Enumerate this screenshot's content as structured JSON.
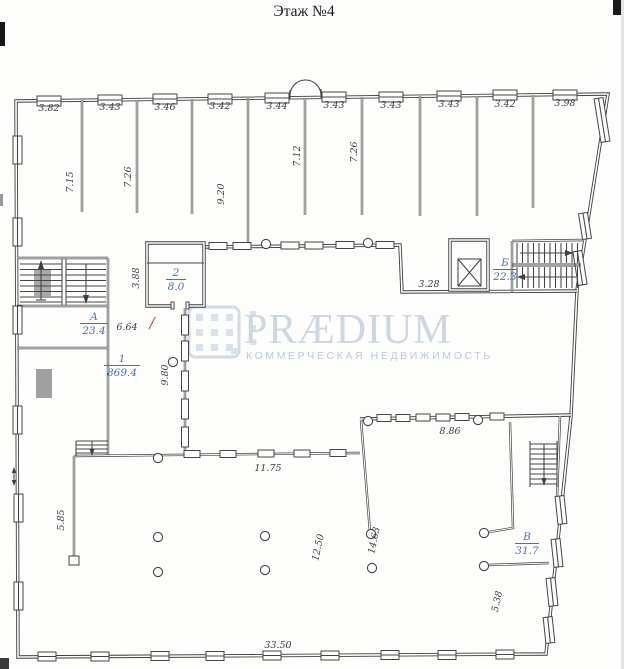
{
  "title": "Этаж №4",
  "watermark": {
    "brand": "PRÆDIUM",
    "tagline": "КОММЕРЧЕСКАЯ НЕДВИЖИМОСТЬ"
  },
  "rooms": {
    "r1": {
      "num": "1",
      "area": "869.4"
    },
    "r2": {
      "num": "2",
      "area": "8.0"
    },
    "rA": {
      "num": "А",
      "area": "23.4"
    },
    "rB": {
      "num": "Б",
      "area": "22.3"
    },
    "rV": {
      "num": "В",
      "area": "31.7"
    }
  },
  "red_mark": "/",
  "dims": {
    "top": [
      "3.82",
      "3.43",
      "3.46",
      "3.42",
      "3.44",
      "3.43",
      "3.43",
      "3.43",
      "3.42",
      "3.98"
    ],
    "depths": [
      "7.15",
      "7.26",
      "9.20",
      "7.12",
      "7.26"
    ],
    "closet_width": "3.88",
    "lift_span": "3.28",
    "inner_gap": "6.64",
    "west_hall_depth": "9.80",
    "south_wall": "11.75",
    "southeast_top": "8.86",
    "left_lower": "5.85",
    "open_span_a": "12.50",
    "open_span_b": "14.63",
    "southeast_side": "5.38",
    "bottom_total": "33.50"
  },
  "colors": {
    "line": "#3e3e3e",
    "room_label": "#4671b4",
    "red_mark": "#c54138",
    "watermark": "#ccd7e2"
  }
}
